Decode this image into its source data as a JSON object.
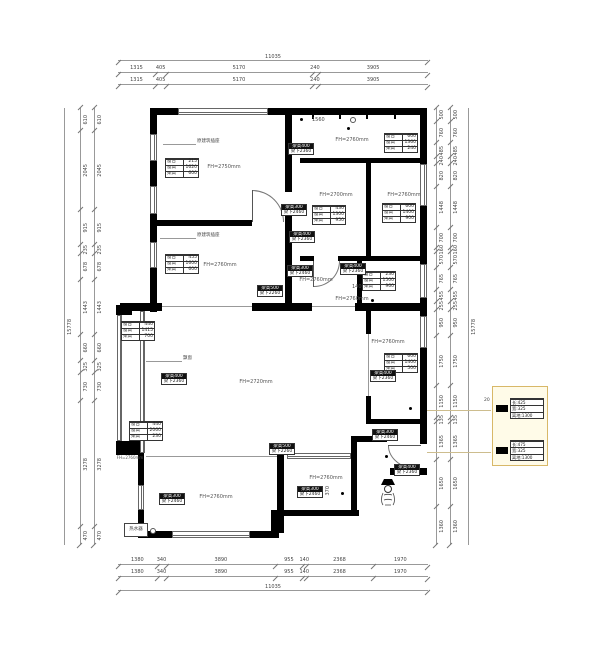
{
  "colors": {
    "wall": "#000000",
    "dimline": "#999999",
    "legend_bg": "#fffbe8",
    "legend_border": "#d8b868"
  },
  "dims": {
    "top": {
      "overall": "11035",
      "segments": [
        "1315",
        "405",
        "5170",
        "240",
        "3905"
      ]
    },
    "bottom": {
      "overall": "11035",
      "segments": [
        "1380",
        "340",
        "3890",
        "955",
        "140",
        "2368",
        "1970"
      ]
    },
    "left": {
      "overall": "15778",
      "segments": [
        "610",
        "2045",
        "915",
        "235",
        "678",
        "1443",
        "660",
        "325",
        "730",
        "3278",
        "470"
      ]
    },
    "right": {
      "overall": "15778",
      "segments": [
        "500",
        "760",
        "485",
        "240",
        "820",
        "1448",
        "700",
        "160",
        "570",
        "765",
        "455",
        "255",
        "950",
        "1750",
        "1150",
        "135",
        "1365",
        "1650",
        "1360"
      ]
    }
  },
  "rooms": [
    {
      "fh": "FH=2750mm"
    },
    {
      "fh": "FH=2760mm"
    },
    {
      "fh": "FH=2760mm"
    },
    {
      "fh": "FH=2700mm"
    },
    {
      "fh": "FH=2760mm"
    },
    {
      "fh": "FH=2760mm"
    },
    {
      "fh": "FH=2760mm"
    },
    {
      "fh": "FH=2760mm"
    },
    {
      "fh": "FH=2720mm"
    },
    {
      "fh": "FH=2760mm"
    },
    {
      "fh": "FH=2760mm"
    },
    {
      "fh": "FH=2760mm"
    }
  ],
  "window_tables": [
    {
      "rows": [
        {
          "k": "窗台",
          "v": "215"
        },
        {
          "k": "窗高",
          "v": "1620"
        },
        {
          "k": "梁高",
          "v": "600"
        }
      ]
    },
    {
      "rows": [
        {
          "k": "窗台",
          "v": "455"
        },
        {
          "k": "窗高",
          "v": "1600"
        },
        {
          "k": "梁高",
          "v": "600"
        }
      ]
    },
    {
      "rows": [
        {
          "k": "窗台",
          "v": "440"
        },
        {
          "k": "窗高",
          "v": "1415"
        },
        {
          "k": "梁高",
          "v": "700"
        }
      ]
    },
    {
      "rows": [
        {
          "k": "窗台",
          "v": "440"
        },
        {
          "k": "窗高",
          "v": "2060"
        },
        {
          "k": "梁高",
          "v": "230"
        }
      ]
    },
    {
      "rows": [
        {
          "k": "窗台",
          "v": "600"
        },
        {
          "k": "窗高",
          "v": "1360"
        },
        {
          "k": "梁高",
          "v": "240"
        }
      ]
    },
    {
      "rows": [
        {
          "k": "窗台",
          "v": "430"
        },
        {
          "k": "窗高",
          "v": "1300"
        },
        {
          "k": "梁高",
          "v": "950"
        }
      ]
    },
    {
      "rows": [
        {
          "k": "窗台",
          "v": "600"
        },
        {
          "k": "窗高",
          "v": "1400"
        },
        {
          "k": "梁高",
          "v": "900"
        }
      ]
    },
    {
      "rows": [
        {
          "k": "窗台",
          "v": "600"
        },
        {
          "k": "窗高",
          "v": "1400"
        },
        {
          "k": "梁高",
          "v": "500"
        }
      ]
    },
    {
      "rows": [
        {
          "k": "窗台",
          "v": "230"
        },
        {
          "k": "窗高",
          "v": "1500"
        },
        {
          "k": "梁高",
          "v": "960"
        }
      ]
    }
  ],
  "beam_notes": [
    {
      "a": "梁高400",
      "b": "梁下2360"
    },
    {
      "a": "梁高300",
      "b": "梁下2460"
    },
    {
      "a": "梁高400",
      "b": "梁下2360"
    },
    {
      "a": "梁高500",
      "b": "梁下2260"
    },
    {
      "a": "梁高300",
      "b": "梁下2460"
    },
    {
      "a": "梁高400",
      "b": "梁下2360"
    },
    {
      "a": "梁高400",
      "b": "梁下2360"
    },
    {
      "a": "梁高300",
      "b": "梁下2460"
    },
    {
      "a": "梁高400",
      "b": "梁下2360"
    },
    {
      "a": "梁高500",
      "b": "梁下2260"
    },
    {
      "a": "梁高300",
      "b": "梁下2460"
    },
    {
      "a": "梁高400",
      "b": "梁下2360"
    },
    {
      "a": "梁高300",
      "b": "梁下2460"
    }
  ],
  "leaders": {
    "socket1": "原建筑插座",
    "socket2": "原建筑插座",
    "bay": "飘窗"
  },
  "inline_dims": {
    "n1560": "1560",
    "n1400": "1400",
    "n1140": "1140",
    "n370": "370",
    "n20": "20"
  },
  "equipment": {
    "water_heater": "热水器"
  },
  "legend": {
    "items": [
      {
        "lines": [
          "长:425",
          "宽:325",
          "离地:1300"
        ]
      },
      {
        "lines": [
          "长:475",
          "宽:325",
          "离地:1300"
        ]
      }
    ]
  }
}
